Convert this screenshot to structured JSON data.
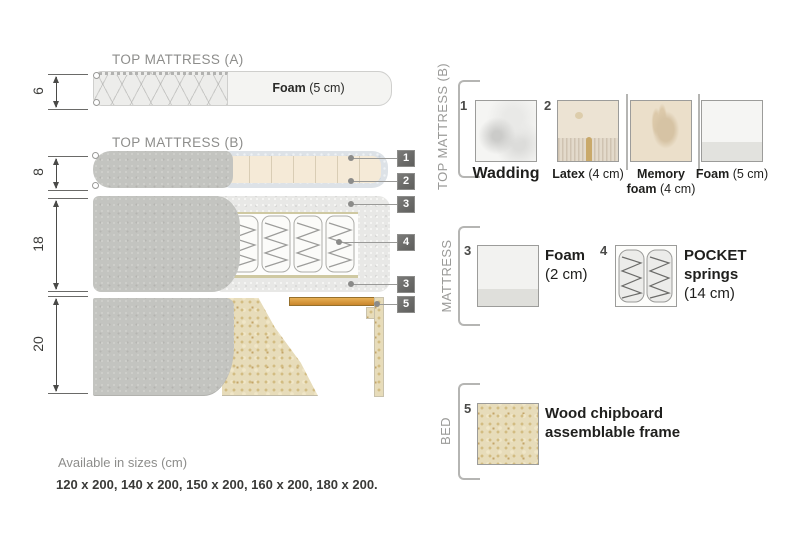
{
  "diagram": {
    "sections": {
      "top_mattress_a": {
        "title": "TOP MATTRESS (A)",
        "height_cm": "6",
        "foam_name": "Foam",
        "foam_detail": " (5 cm)"
      },
      "top_mattress_b": {
        "title": "TOP MATTRESS (B)",
        "height_cm": "8"
      },
      "mattress": {
        "height_cm": "18"
      },
      "bed": {
        "height_cm": "20"
      }
    },
    "callouts": [
      "1",
      "2",
      "3",
      "4",
      "3",
      "5"
    ]
  },
  "legend": {
    "top_mattress_b": {
      "label": "TOP MATTRESS (B)",
      "item1_number": "1",
      "item1_name": "Wadding",
      "item2_number": "2",
      "item2_name": "Latex",
      "item2_detail": " (4 cm)",
      "item3_name_line1": "Memory",
      "item3_name_line2": "foam",
      "item3_detail": " (4 cm)",
      "item4_name": "Foam",
      "item4_detail": " (5 cm)"
    },
    "mattress": {
      "label": "MATTRESS",
      "item3_number": "3",
      "item3_name": "Foam",
      "item3_detail": "(2 cm)",
      "item4_number": "4",
      "item4_name_line1": "POCKET",
      "item4_name_line2": "springs",
      "item4_detail": "(14 cm)"
    },
    "bed": {
      "label": "BED",
      "item5_number": "5",
      "item5_line1": "Wood chipboard",
      "item5_line2": "assemblable frame"
    }
  },
  "footer": {
    "sizes_title": "Available in sizes (cm)",
    "sizes_list": "120 x 200, 140 x 200, 150 x 200, 160 x 200, 180 x 200."
  },
  "colors": {
    "wood_slat": "#cf8f33",
    "fabric_gray": "#c3c4c0",
    "foam_cream": "#f5ead7",
    "wadding": "#dde2e7",
    "chipboard": "#e7dcba",
    "callout_bg": "#6b6b69"
  }
}
